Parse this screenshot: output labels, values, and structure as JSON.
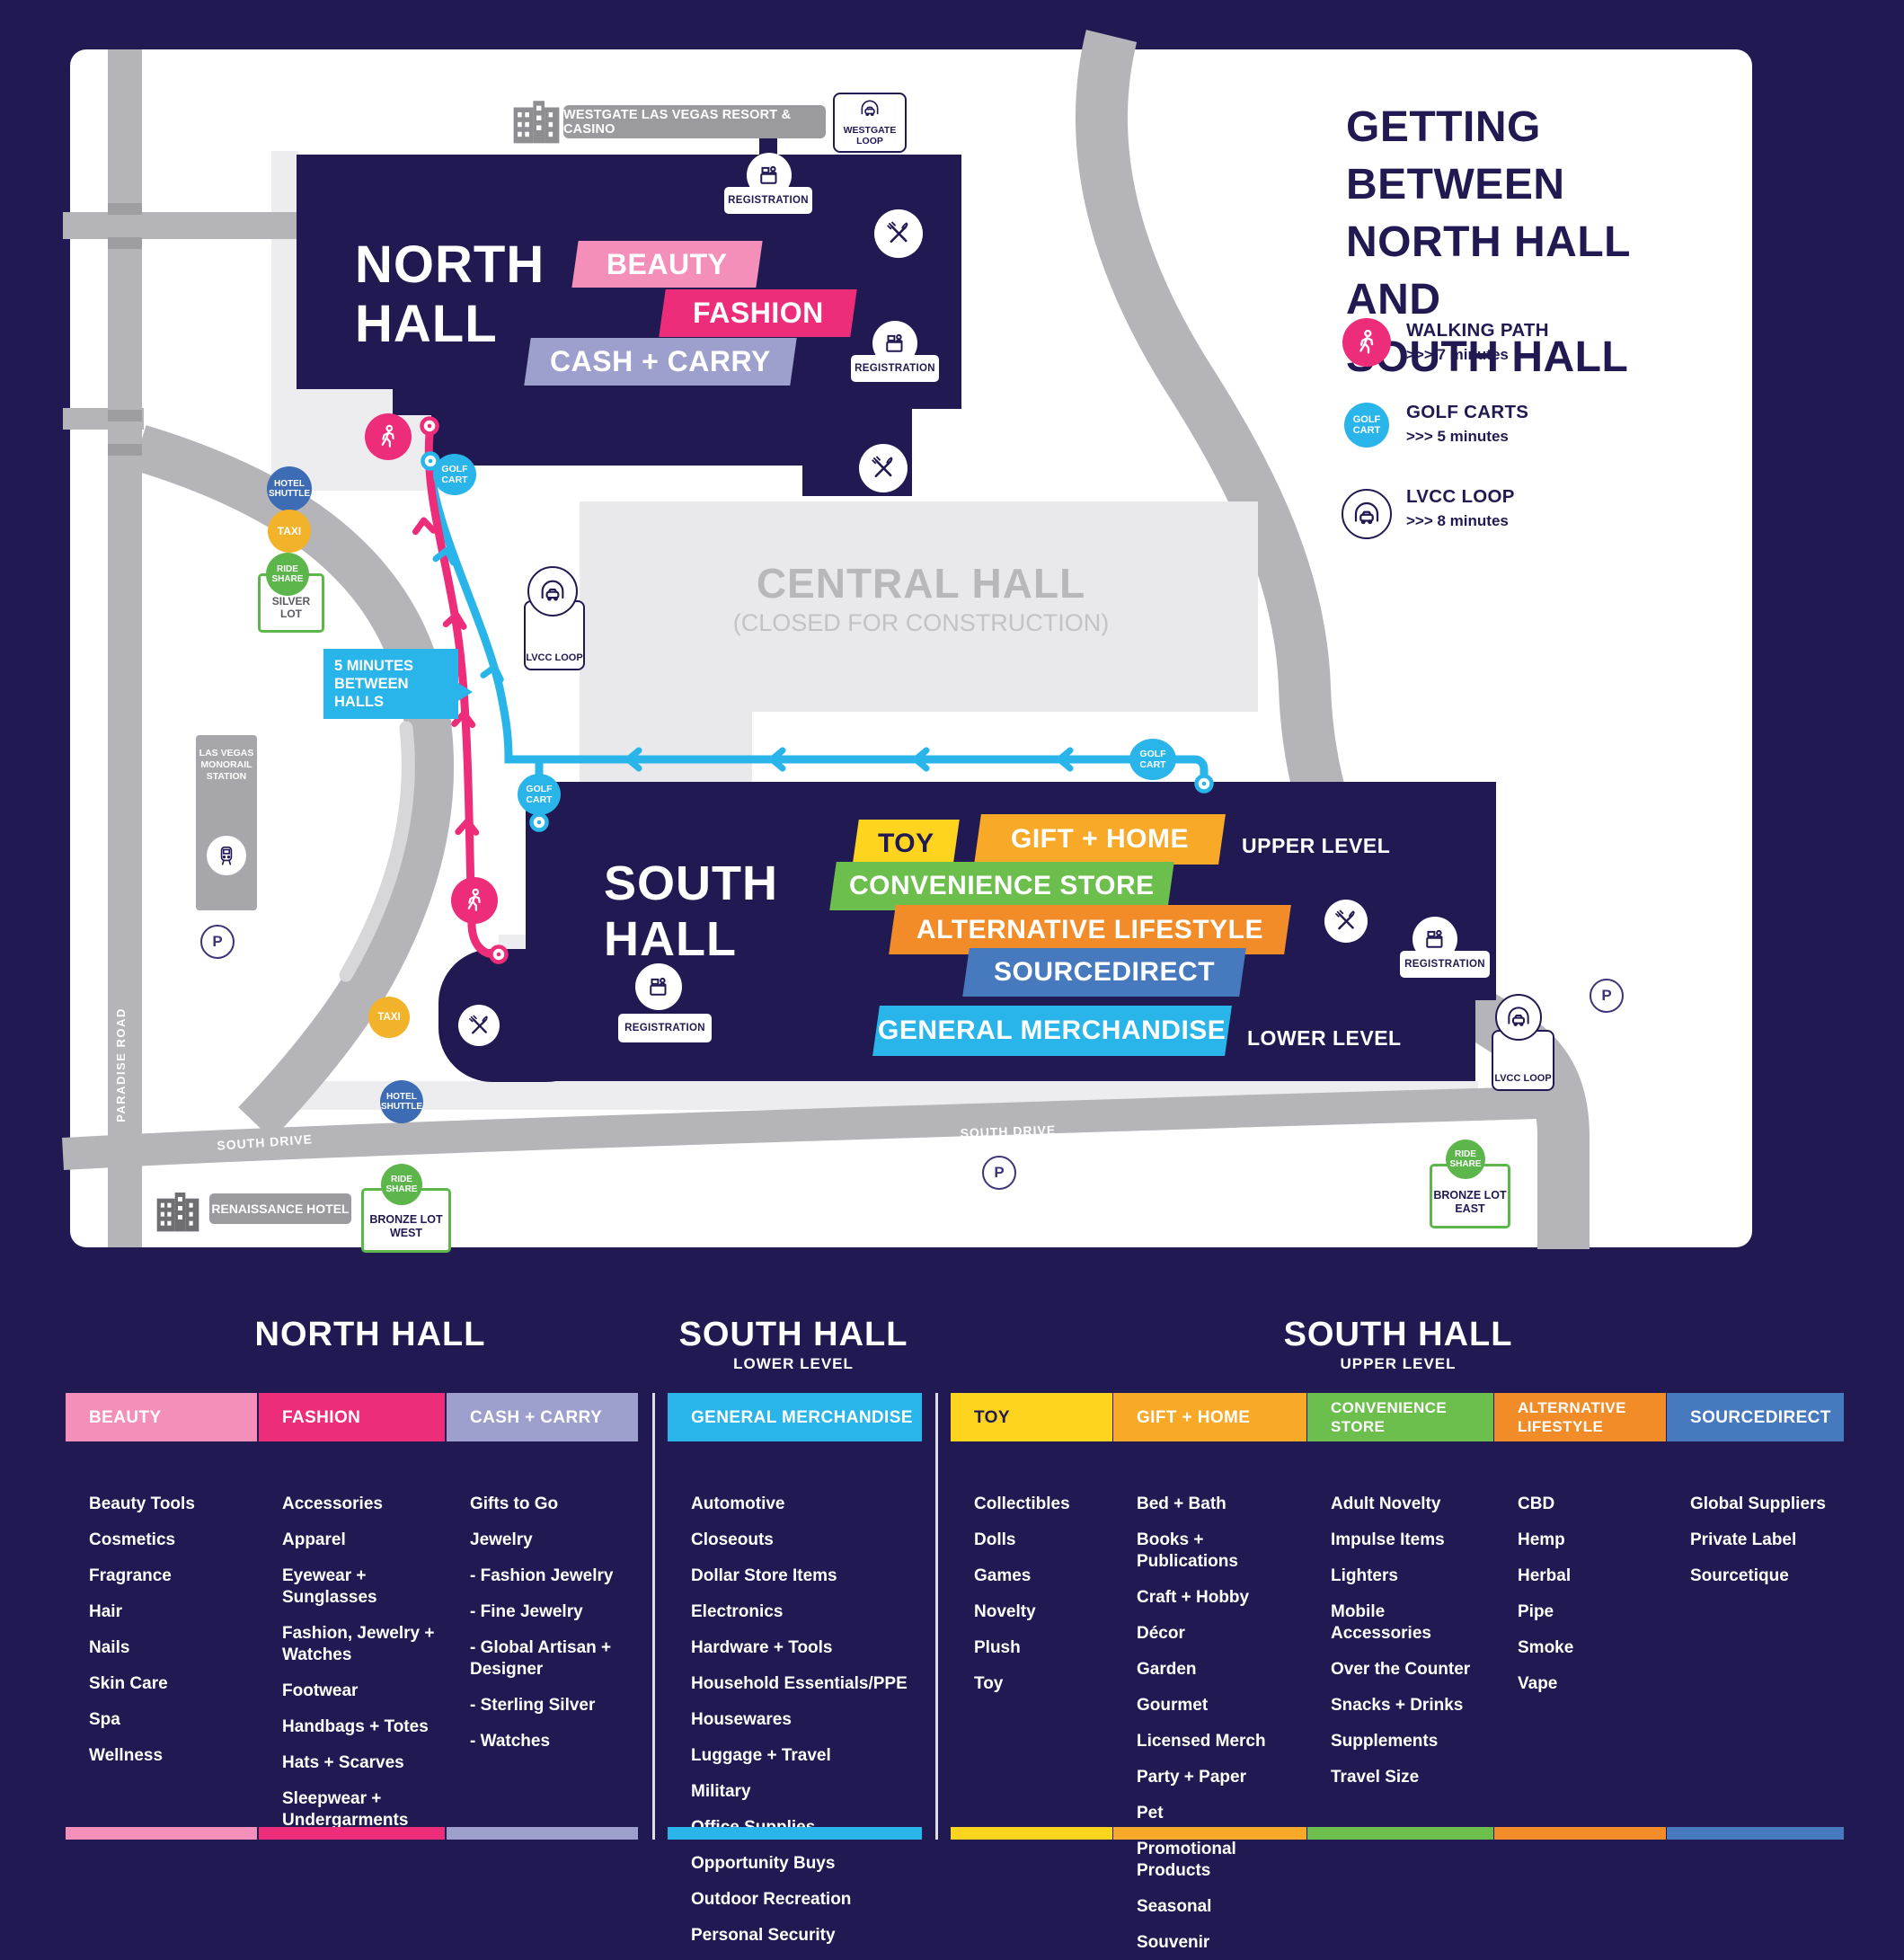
{
  "title_block": {
    "line1": "GETTING BETWEEN",
    "line2": "NORTH HALL AND",
    "line3": "SOUTH  HALL"
  },
  "transit_legend": [
    {
      "label": "WALKING PATH",
      "time": ">>> 7 minutes",
      "icon": "walking-icon",
      "color": "#ee2d7a"
    },
    {
      "label": "GOLF CARTS",
      "time": ">>> 5 minutes",
      "icon": "golf-cart-badge",
      "color": "#29b5ea"
    },
    {
      "label": "LVCC LOOP",
      "time": ">>> 8 minutes",
      "icon": "loop-car-icon",
      "color": "#ffffff"
    }
  ],
  "map": {
    "north_hall": {
      "name": "NORTH\nHALL",
      "categories": [
        {
          "label": "BEAUTY",
          "color": "#f48fb9"
        },
        {
          "label": "FASHION",
          "color": "#ee2d7a"
        },
        {
          "label": "CASH + CARRY",
          "color": "#9d9fcc"
        }
      ]
    },
    "central_hall": {
      "name": "CENTRAL HALL",
      "status": "(CLOSED FOR CONSTRUCTION)"
    },
    "south_hall": {
      "name": "SOUTH\nHALL",
      "upper_level_label": "UPPER LEVEL",
      "lower_level_label": "LOWER LEVEL",
      "categories_upper": [
        {
          "label": "TOY",
          "color": "#ffd41f"
        },
        {
          "label": "GIFT + HOME",
          "color": "#f9a928"
        },
        {
          "label": "CONVENIENCE STORE",
          "color": "#6cbf4d"
        },
        {
          "label": "ALTERNATIVE LIFESTYLE",
          "color": "#f28c28"
        },
        {
          "label": "SOURCEDIRECT",
          "color": "#4679bd"
        }
      ],
      "category_lower": {
        "label": "GENERAL MERCHANDISE",
        "color": "#29b5ea"
      }
    },
    "poi": {
      "westgate": "WESTGATE LAS VEGAS RESORT & CASINO",
      "westgate_loop": "WESTGATE LOOP",
      "registration": "REGISTRATION",
      "hotel_shuttle": "HOTEL SHUTTLE",
      "taxi": "TAXI",
      "ride_share": "RIDE SHARE",
      "silver_lot": "SILVER LOT",
      "monorail_station": "LAS VEGAS MONORAIL STATION",
      "lvcc_loop": "LVCC LOOP",
      "golf_cart": "GOLF CART",
      "between_halls": "5 MINUTES BETWEEN HALLS",
      "bronze_lot_west": "BRONZE LOT WEST",
      "bronze_lot_east": "BRONZE LOT EAST",
      "renaissance_hotel": "RENAISSANCE HOTEL",
      "parking": "P"
    },
    "roads": {
      "paradise": "PARADISE ROAD",
      "south_drive": "SOUTH DRIVE",
      "silver_drive": "SILVER DRIVE",
      "joe_w_brown": "JOE W BROWN DRIVE"
    }
  },
  "legend": {
    "sections": [
      {
        "title": "NORTH HALL",
        "subtitle": "",
        "columns": [
          {
            "label": "BEAUTY",
            "color": "#f48fb9",
            "items": [
              "Beauty Tools",
              "Cosmetics",
              "Fragrance",
              "Hair",
              "Nails",
              "Skin Care",
              "Spa",
              "Wellness"
            ]
          },
          {
            "label": "FASHION",
            "color": "#ee2d7a",
            "items": [
              "Accessories",
              "Apparel",
              "Eyewear + Sunglasses",
              "Fashion, Jewelry + Watches",
              "Footwear",
              "Handbags + Totes",
              "Hats + Scarves",
              "Sleepwear + Undergarments"
            ]
          },
          {
            "label": "CASH + CARRY",
            "color": "#9d9fcc",
            "items": [
              "Gifts to Go",
              "Jewelry",
              "- Fashion Jewelry",
              "- Fine Jewelry",
              "- Global Artisan + Designer",
              "- Sterling Silver",
              "- Watches"
            ]
          }
        ]
      },
      {
        "title": "SOUTH HALL",
        "subtitle": "LOWER LEVEL",
        "columns": [
          {
            "label": "GENERAL MERCHANDISE",
            "color": "#29b5ea",
            "items": [
              "Automotive",
              "Closeouts",
              "Dollar Store Items",
              "Electronics",
              "Hardware + Tools",
              "Household Essentials/PPE",
              "Housewares",
              "Luggage + Travel",
              "Military",
              "Office Supplies",
              "Opportunity Buys",
              "Outdoor Recreation",
              "Personal Security",
              "Sporting Goods"
            ]
          }
        ]
      },
      {
        "title": "SOUTH HALL",
        "subtitle": "UPPER LEVEL",
        "columns": [
          {
            "label": "TOY",
            "color": "#ffd41f",
            "items": [
              "Collectibles",
              "Dolls",
              "Games",
              "Novelty",
              "Plush",
              "Toy"
            ]
          },
          {
            "label": "GIFT + HOME",
            "color": "#f9a928",
            "items": [
              "Bed + Bath",
              "Books + Publications",
              "Craft + Hobby",
              "Décor",
              "Garden",
              "Gourmet",
              "Licensed Merch",
              "Party + Paper",
              "Pet",
              "Promotional Products",
              "Seasonal",
              "Souvenir"
            ]
          },
          {
            "label": "CONVENIENCE STORE",
            "color": "#6cbf4d",
            "items": [
              "Adult Novelty",
              "Impulse Items",
              "Lighters",
              "Mobile Accessories",
              "Over the Counter",
              "Snacks + Drinks",
              "Supplements",
              "Travel Size"
            ]
          },
          {
            "label": "ALTERNATIVE LIFESTYLE",
            "color": "#f28c28",
            "items": [
              "CBD",
              "Hemp",
              "Herbal",
              "Pipe",
              "Smoke",
              "Vape"
            ]
          },
          {
            "label": "SOURCEDIRECT",
            "color": "#4679bd",
            "items": [
              "Global Suppliers",
              "Private Label",
              "Sourcetique"
            ]
          }
        ]
      }
    ]
  }
}
